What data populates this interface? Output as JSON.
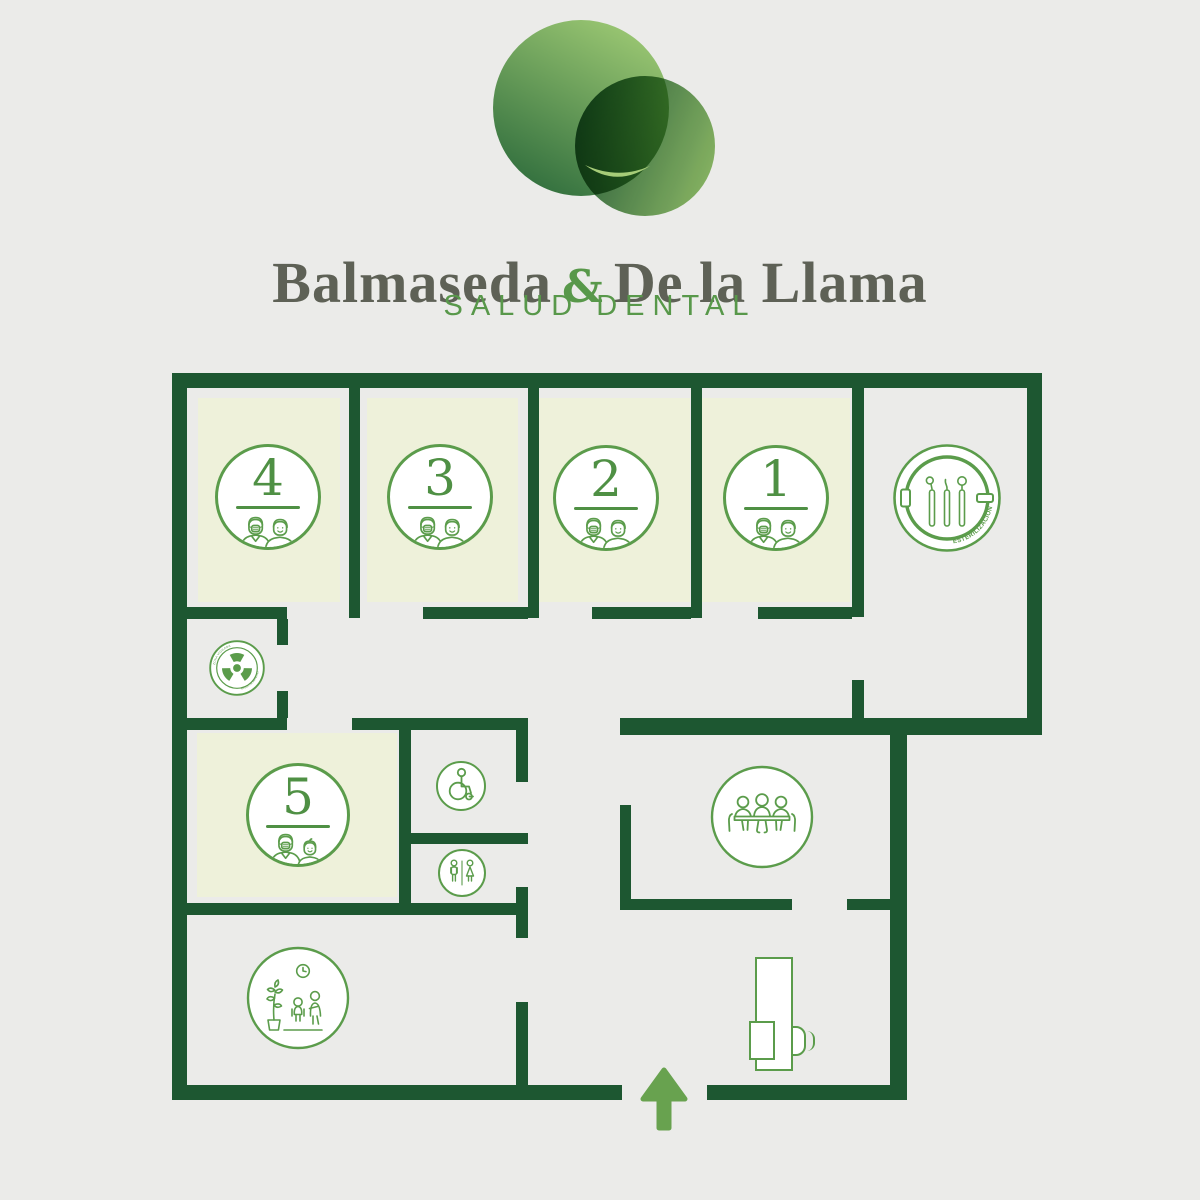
{
  "brand": {
    "name_left": "Balmaseda",
    "ampersand": "&",
    "name_right": "De la Llama",
    "tagline": "SALUD DENTAL"
  },
  "floor_plan": {
    "treatment_rooms": [
      {
        "number": "4"
      },
      {
        "number": "3"
      },
      {
        "number": "2"
      },
      {
        "number": "1"
      },
      {
        "number": "5"
      }
    ],
    "sterilization": {
      "label": "ESTERILIZACIÓN"
    },
    "radiology": {
      "ring_label_top": "ZONA VIGILADA",
      "ring_label_bottom": "RIESGO DE IRRADIACIÓN"
    }
  },
  "colors": {
    "wall": "#1d5731",
    "outline_green": "#5b9c4b",
    "room_number_green": "#4f9044",
    "room_fill": "#eef1da",
    "background": "#ebebe9",
    "entrance_arrow": "#68a24f",
    "brand_text": "#5e6156",
    "tagline_green": "#58984a",
    "logo_dark_green": "#1f5c35",
    "logo_light_green": "#96c46c"
  }
}
